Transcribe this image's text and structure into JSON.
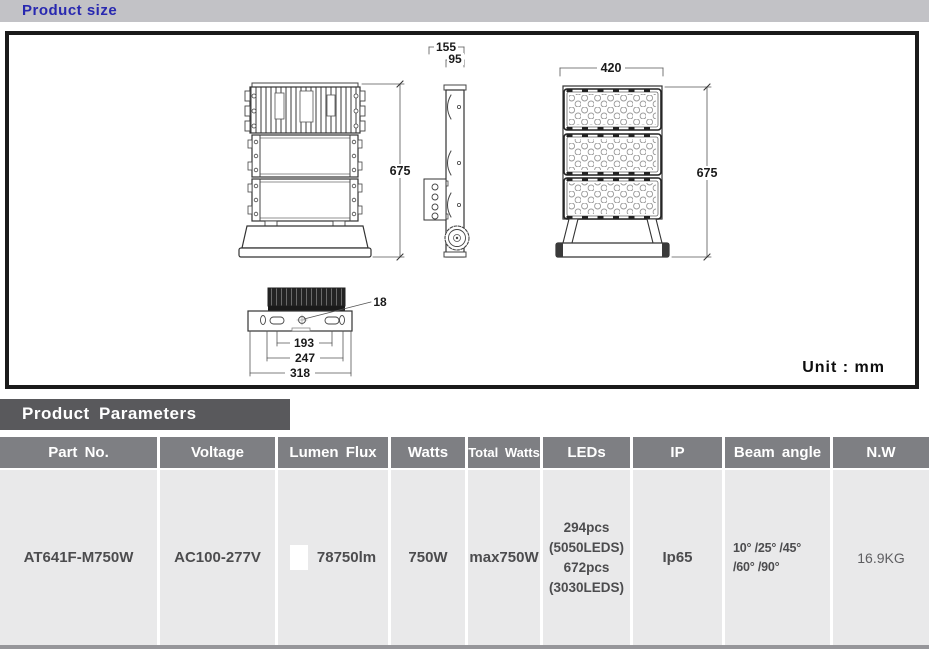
{
  "page": {
    "section1_title": "Product size",
    "section2_title": "Product Parameters",
    "unit_label": "Unit : mm"
  },
  "drawing": {
    "back_height": "675",
    "side_depth_total": "155",
    "side_depth_body": "95",
    "front_width": "420",
    "front_height": "675",
    "mount_hole": "18",
    "mount_span_inner": "193",
    "mount_span_mid": "247",
    "mount_span_outer": "318"
  },
  "table": {
    "headers": [
      "Part No.",
      "Voltage",
      "Lumen Flux",
      "Watts",
      "Total Watts",
      "LEDs",
      "IP",
      "Beam angle",
      "N.W"
    ],
    "row": {
      "part_no": "AT641F-M750W",
      "voltage": "AC100-277V",
      "lumen_flux": "78750lm",
      "watts": "750W",
      "total_watts": "max750W",
      "leds_line1": "294pcs",
      "leds_line2": "(5050LEDS)",
      "leds_line3": "672pcs",
      "leds_line4": "(3030LEDS)",
      "ip": "Ip65",
      "beam_angle_line1": "10° /25° /45°",
      "beam_angle_line2": "/60° /90°",
      "nw": "16.9KG"
    }
  },
  "colors": {
    "accent_blue": "#2828b0",
    "topbar_gray": "#c2c2c6",
    "section_bar_dark": "#59595c",
    "table_header_gray": "#7e7f83",
    "table_row_gray": "#e9e9ea"
  }
}
